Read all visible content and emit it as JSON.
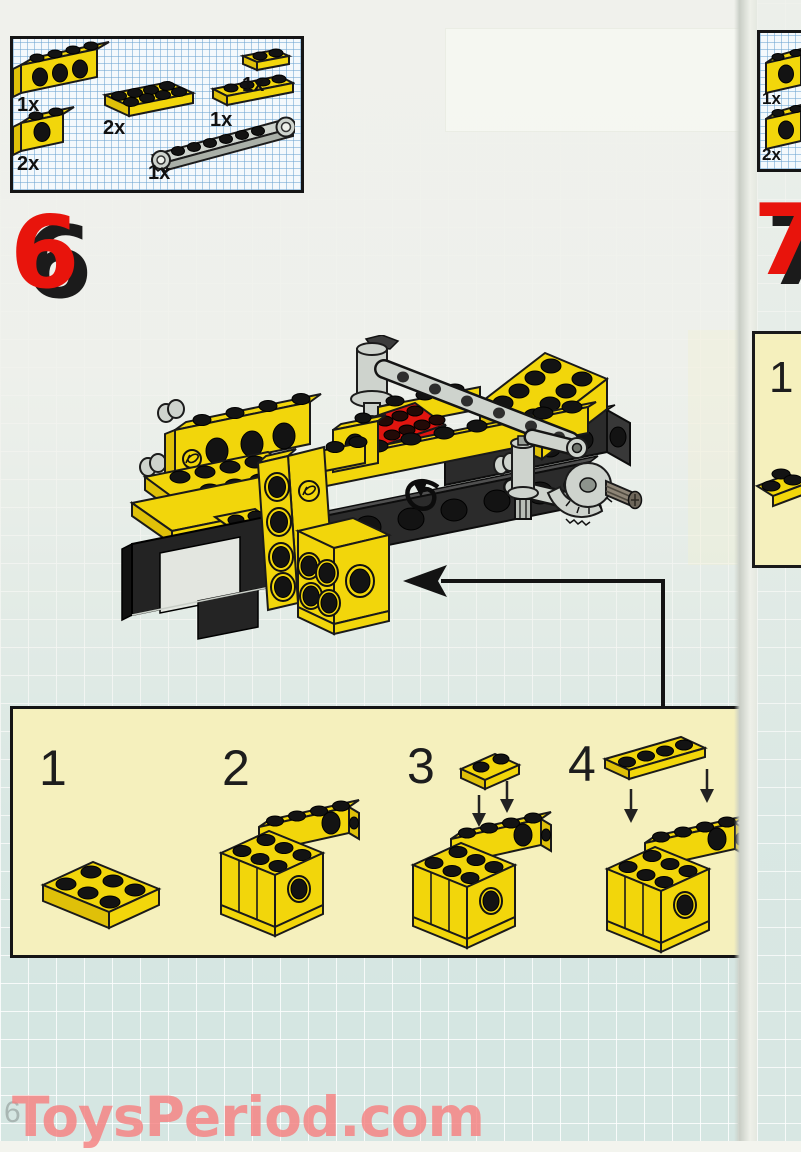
{
  "page": {
    "number": "6",
    "watermark": "ToysPeriod.com"
  },
  "step": {
    "number": "6"
  },
  "parts_box": {
    "items": [
      {
        "qty": "1x",
        "part": "technic-brick-1x4-holes-yellow"
      },
      {
        "qty": "2x",
        "part": "technic-brick-1x2-hole-yellow"
      },
      {
        "qty": "2x",
        "part": "plate-2x4-yellow"
      },
      {
        "qty": "1x",
        "part": "plate-1x2-yellow"
      },
      {
        "qty": "1x",
        "part": "plate-1x4-yellow"
      },
      {
        "qty": "1x",
        "part": "technic-steering-arm-gray"
      }
    ]
  },
  "substeps": {
    "labels": [
      "1",
      "2",
      "3",
      "4"
    ]
  },
  "next_page": {
    "step_number": "7",
    "parts": [
      {
        "qty": "1x"
      },
      {
        "qty": "2x"
      }
    ],
    "substep_label": "1"
  },
  "colors": {
    "brick_yellow": "#f2d60b",
    "brick_red": "#e0150f",
    "step_number_red": "#e8140c",
    "gray_part": "#ced3cd",
    "panel_bg": "#f5f0bd",
    "watermark_pink": "#f38080",
    "grid_blue": "#7fb3d9"
  }
}
